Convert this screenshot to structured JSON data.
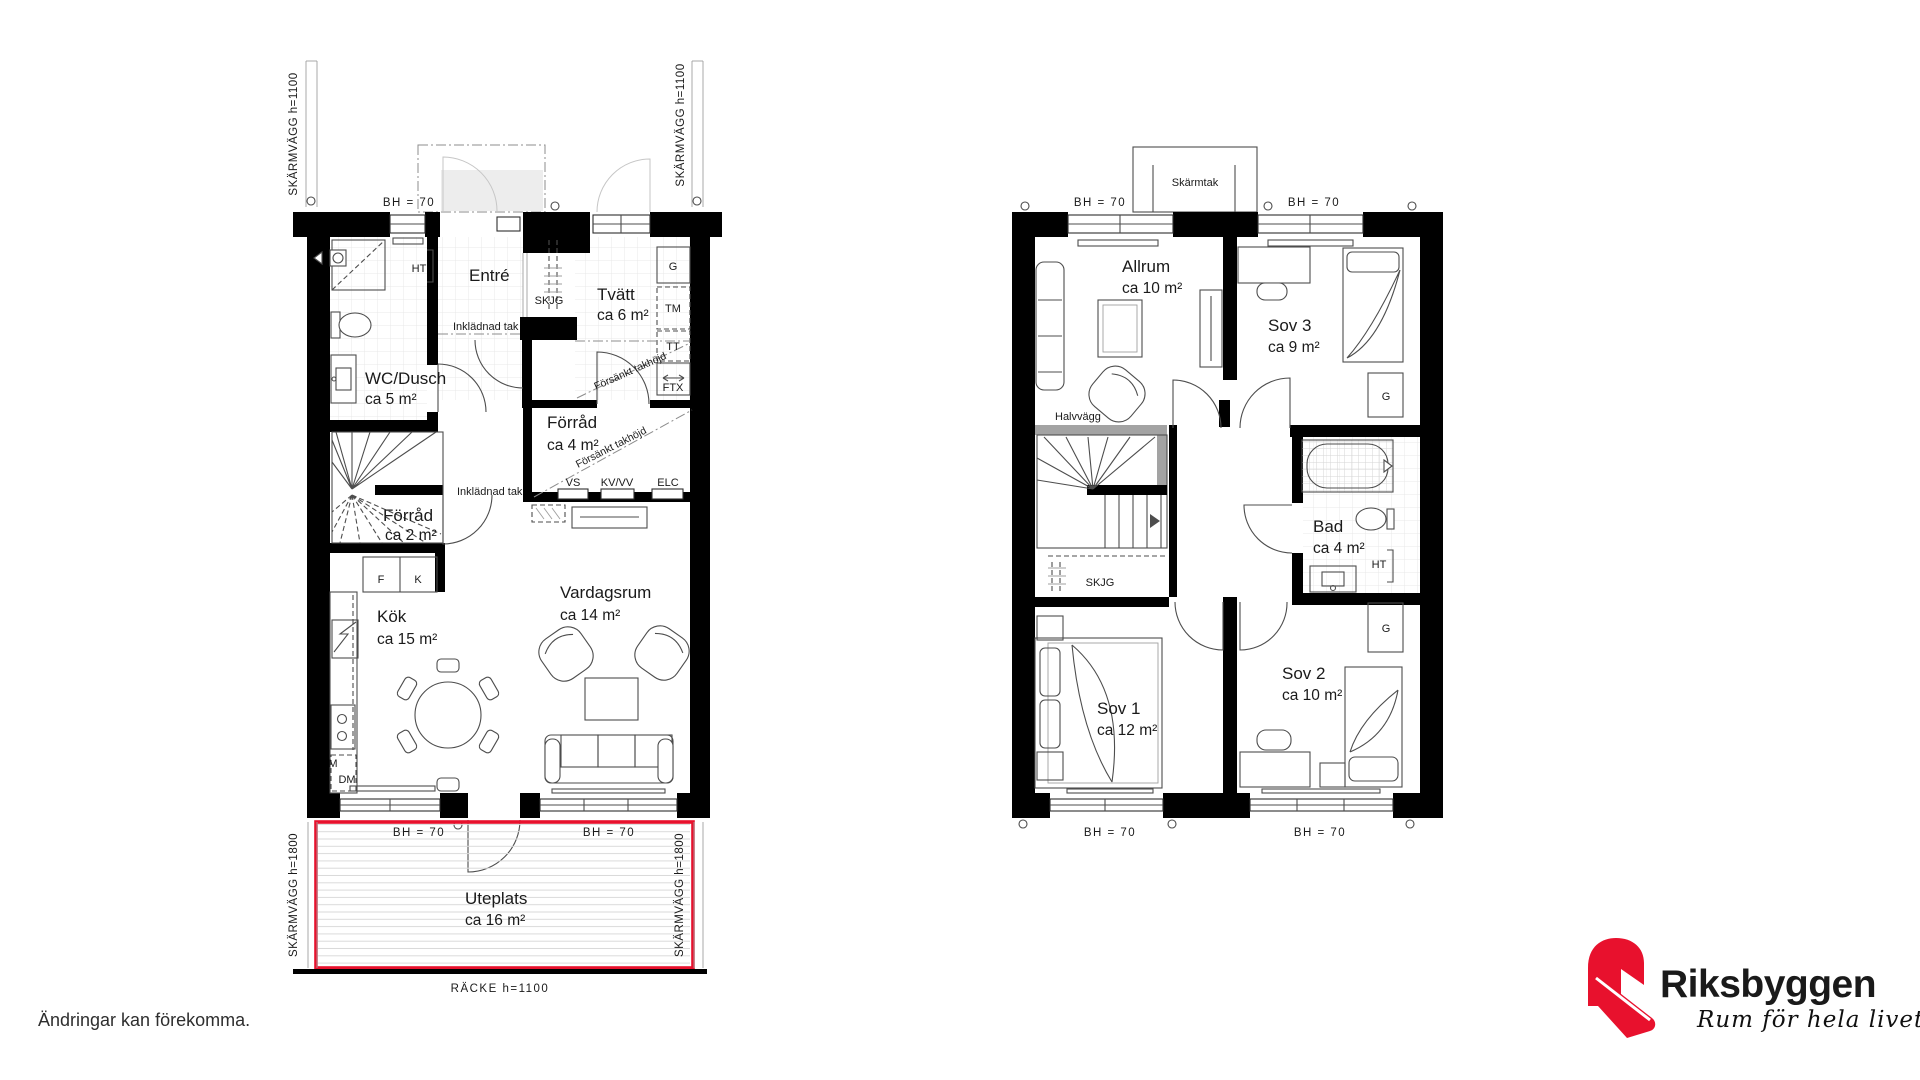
{
  "colors": {
    "wall": "#000000",
    "accent_red": "#e8112d",
    "logo_gray": "#8a8d8f"
  },
  "floor1": {
    "rooms": {
      "entre": {
        "name": "Entré"
      },
      "wc_dusch": {
        "name": "WC/Dusch",
        "area": "ca 5 m²"
      },
      "tvatt": {
        "name": "Tvätt",
        "area": "ca 6 m²"
      },
      "forrad_4": {
        "name": "Förråd",
        "area": "ca 4 m²"
      },
      "forrad_2": {
        "name": "Förråd",
        "area": "ca 2 m²"
      },
      "kok": {
        "name": "Kök",
        "area": "ca 15 m²"
      },
      "vardagsrum": {
        "name": "Vardagsrum",
        "area": "ca 14 m²"
      },
      "uteplats": {
        "name": "Uteplats",
        "area": "ca 16 m²"
      }
    },
    "labels": {
      "skarmvagg_1100": "SKÄRMVÄGG h=1100",
      "skarmvagg_1800": "SKÄRMVÄGG h=1800",
      "racke_1100": "RÄCKE h=1100",
      "bh_70": "BH = 70",
      "inkladnad_tak": "Inklädnad tak",
      "forsankt_takhojd": "Försänkt takhöjd",
      "ht": "HT",
      "skjg": "SKJG",
      "g": "G",
      "tm": "TM",
      "tt": "TT",
      "ftx": "FTX",
      "vs": "VS",
      "kv_vv": "KV/VV",
      "elc": "ELC",
      "f": "F",
      "k": "K",
      "m": "M",
      "dm": "DM"
    }
  },
  "floor2": {
    "rooms": {
      "allrum": {
        "name": "Allrum",
        "area": "ca 10 m²"
      },
      "sov1": {
        "name": "Sov 1",
        "area": "ca 12 m²"
      },
      "sov2": {
        "name": "Sov 2",
        "area": "ca 10 m²"
      },
      "sov3": {
        "name": "Sov 3",
        "area": "ca 9 m²"
      },
      "bad": {
        "name": "Bad",
        "area": "ca 4 m²"
      }
    },
    "labels": {
      "skarmtak": "Skärmtak",
      "bh_70": "BH = 70",
      "halvvagg": "Halvvägg",
      "skjg": "SKJG",
      "g": "G",
      "ht": "HT"
    }
  },
  "footer": {
    "disclaimer": "Ändringar kan förekomma."
  },
  "logo": {
    "brand": "Riksbyggen",
    "tagline": "Rum för hela livet"
  }
}
